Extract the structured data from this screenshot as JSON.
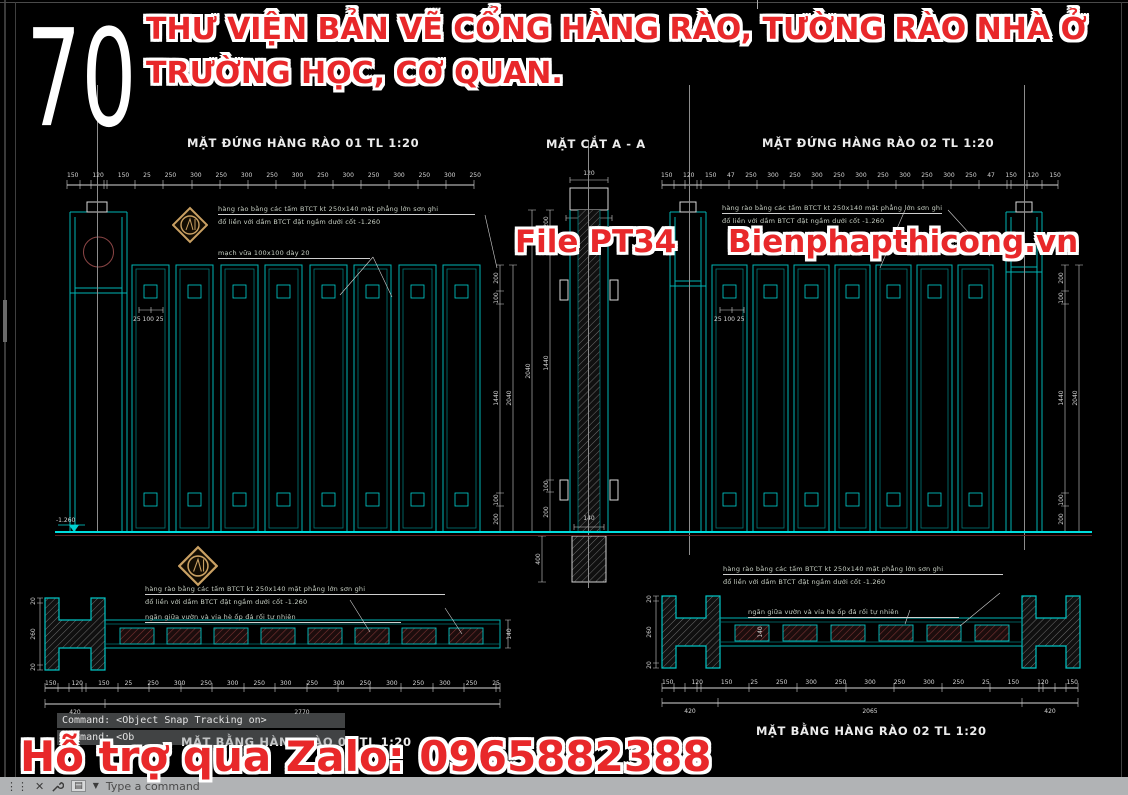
{
  "header": {
    "number": "70",
    "title_line1": "THƯ VIỆN BẢN VẼ CỔNG HÀNG RÀO, TƯỜNG RÀO NHÀ Ở",
    "title_line2": "TRƯỜNG HỌC, CƠ QUAN."
  },
  "watermarks": {
    "file_label": "File PT34",
    "website": "Bienphapthicong.vn",
    "zalo": "Hỗ trợ qua Zalo: 0965882388"
  },
  "colors": {
    "red": "#e8282a",
    "cyan": "#00b4b4",
    "gold": "#c9a063",
    "maroon": "#5c2020"
  },
  "elevation01": {
    "title": "MẶT ĐỨNG HÀNG RÀO 01 TL 1:20",
    "dims_top": [
      "150",
      "120",
      "150",
      "25",
      "250",
      "300",
      "250",
      "300",
      "250",
      "300",
      "250",
      "300",
      "250",
      "300",
      "250",
      "300",
      "250"
    ],
    "dims_right": [
      "200",
      "100",
      "1440",
      "100",
      "200"
    ],
    "dim_overall": "2040",
    "level": "-1.260",
    "small_dim": "25 100 25",
    "ann1": "hàng rào bằng các tấm BTCT kt 250x140 mặt phẳng lớn sơn ghi",
    "ann2": "đổ liền với dầm BTCT đặt ngầm dưới cốt -1.260",
    "ann3": "mạch vữa 100x100 dày 20"
  },
  "section": {
    "title": "MẶT CẮT A - A",
    "dim_top": "120",
    "dim_cap": "140",
    "dim_overall": "2040",
    "dims_inner": [
      "200",
      "100",
      "1440",
      "100",
      "200"
    ],
    "dim_foundation": "400",
    "dim_base": "140"
  },
  "elevation02": {
    "title": "MẶT ĐỨNG HÀNG RÀO 02 TL 1:20",
    "dims_top": [
      "150",
      "120",
      "150",
      "47",
      "250",
      "300",
      "250",
      "300",
      "250",
      "300",
      "250",
      "300",
      "250",
      "300",
      "250",
      "47",
      "150",
      "120",
      "150"
    ],
    "dims_right": [
      "200",
      "100",
      "1440",
      "100",
      "200"
    ],
    "dim_overall": "2040",
    "small_dim": "25 100 25",
    "ann1": "hàng rào bằng các tấm BTCT kt 250x140 mặt phẳng lớn sơn ghi",
    "ann2": "đổ liền với dầm BTCT đặt ngầm dưới cốt -1.260"
  },
  "plan01": {
    "title": "MẶT BẰNG HÀNG RÀO 01 TL 1:20",
    "ann1": "hàng rào bằng các tấm BTCT kt 250x140 mặt phẳng lớn sơn ghi",
    "ann2": "đổ liền với dầm BTCT đặt ngầm dưới cốt -1.260",
    "ann3": "ngăn giữa vườn và vỉa hè ốp đá rối tự nhiên",
    "dims_bottom": [
      "150",
      "120",
      "150",
      "25",
      "250",
      "300",
      "250",
      "300",
      "250",
      "300",
      "250",
      "300",
      "250",
      "300",
      "250",
      "300",
      "250",
      "25"
    ],
    "totals": [
      "420",
      "2770"
    ],
    "dims_left": [
      "20",
      "260",
      "20"
    ],
    "dim_right": "140"
  },
  "plan02": {
    "title": "MẶT BẰNG HÀNG RÀO 02 TL 1:20",
    "ann1": "hàng rào bằng các tấm BTCT kt 250x140 mặt phẳng lớn sơn ghi",
    "ann2": "đổ liền với dầm BTCT đặt ngầm dưới cốt -1.260",
    "ann3": "ngăn giữa vườn và vỉa hè ốp đá rối tự nhiên",
    "dims_bottom": [
      "150",
      "120",
      "150",
      "25",
      "250",
      "300",
      "250",
      "300",
      "250",
      "300",
      "250",
      "25",
      "150",
      "120",
      "150"
    ],
    "totals": [
      "420",
      "2065",
      "420"
    ],
    "dims_left": [
      "20",
      "260",
      "20"
    ],
    "dim_mid": "140"
  },
  "command": {
    "history1": "Command: <Object Snap Tracking on>",
    "history2": "Command: <Ob",
    "input_placeholder": "Type a command"
  }
}
